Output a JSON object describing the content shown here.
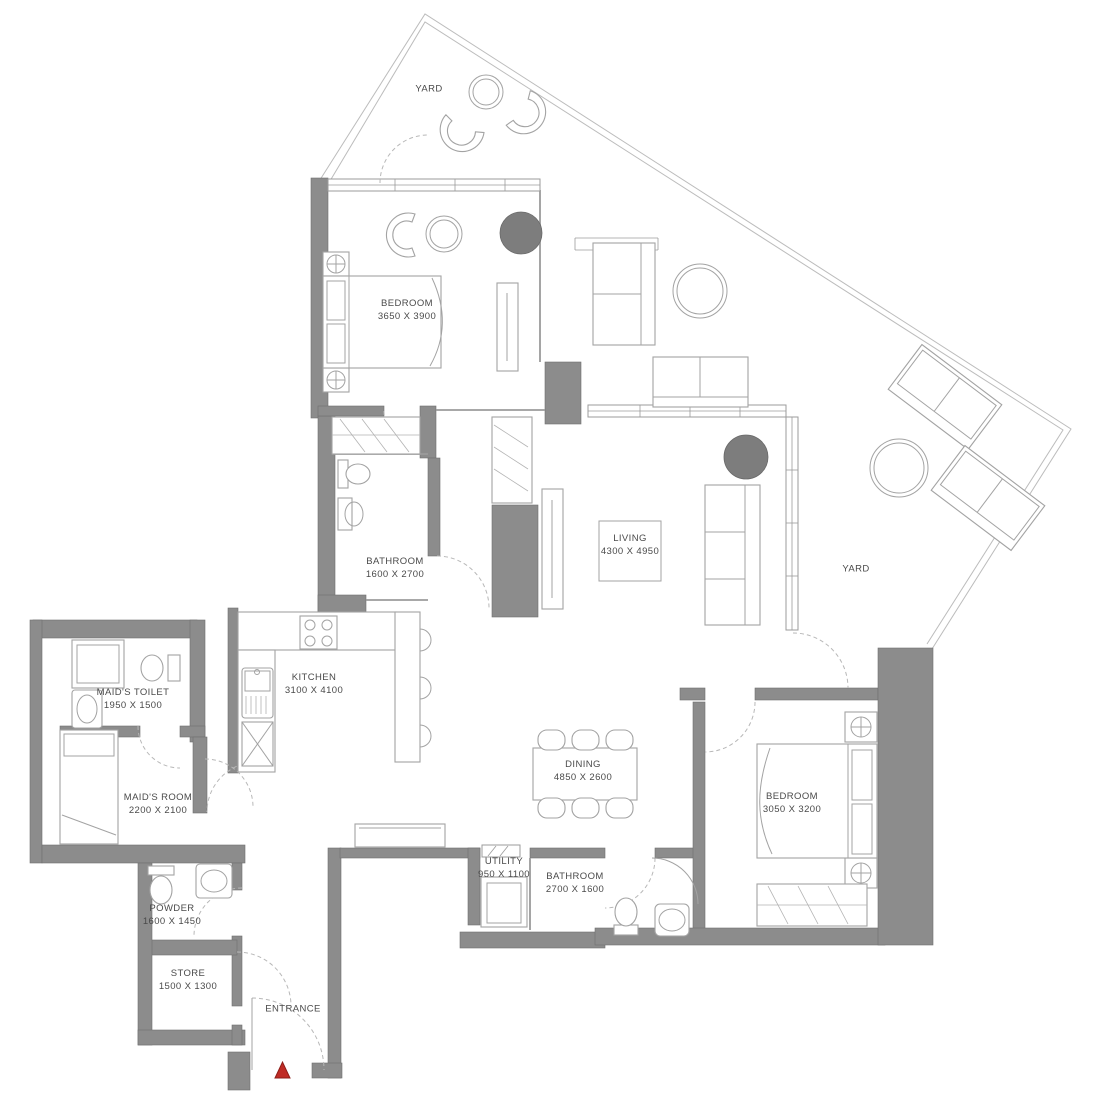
{
  "palette": {
    "background": "#ffffff",
    "wall_fill": "#8c8c8c",
    "wall_edge": "#6f6f6f",
    "furniture_line": "#a3a3a3",
    "label_color": "#4a4a4a",
    "dark_furniture": "#7d7d7d",
    "entrance_marker": "#bf2b25"
  },
  "icons": {
    "entrance_marker": "red-triangle-up",
    "side_table": "circle-with-cross",
    "door_swing": "dashed-quarter-arc"
  },
  "rooms": [
    {
      "id": "yard-top",
      "name": "YARD",
      "dims": ""
    },
    {
      "id": "bedroom-1",
      "name": "BEDROOM",
      "dims": "3650 X 3900"
    },
    {
      "id": "living",
      "name": "LIVING",
      "dims": "4300 X 4950"
    },
    {
      "id": "yard-right",
      "name": "YARD",
      "dims": ""
    },
    {
      "id": "bathroom-1",
      "name": "BATHROOM",
      "dims": "1600 X 2700"
    },
    {
      "id": "kitchen",
      "name": "KITCHEN",
      "dims": "3100 X 4100"
    },
    {
      "id": "maids-toilet",
      "name": "MAID'S TOILET",
      "dims": "1950 X 1500"
    },
    {
      "id": "maids-room",
      "name": "MAID'S ROOM",
      "dims": "2200 X 2100"
    },
    {
      "id": "dining",
      "name": "DINING",
      "dims": "4850 X 2600"
    },
    {
      "id": "bedroom-2",
      "name": "BEDROOM",
      "dims": "3050 X 3200"
    },
    {
      "id": "utility",
      "name": "UTILITY",
      "dims": "950 X 1100"
    },
    {
      "id": "bathroom-2",
      "name": "BATHROOM",
      "dims": "2700 X 1600"
    },
    {
      "id": "powder",
      "name": "POWDER",
      "dims": "1600 X 1450"
    },
    {
      "id": "store",
      "name": "STORE",
      "dims": "1500 X 1300"
    },
    {
      "id": "entrance",
      "name": "ENTRANCE",
      "dims": ""
    }
  ]
}
